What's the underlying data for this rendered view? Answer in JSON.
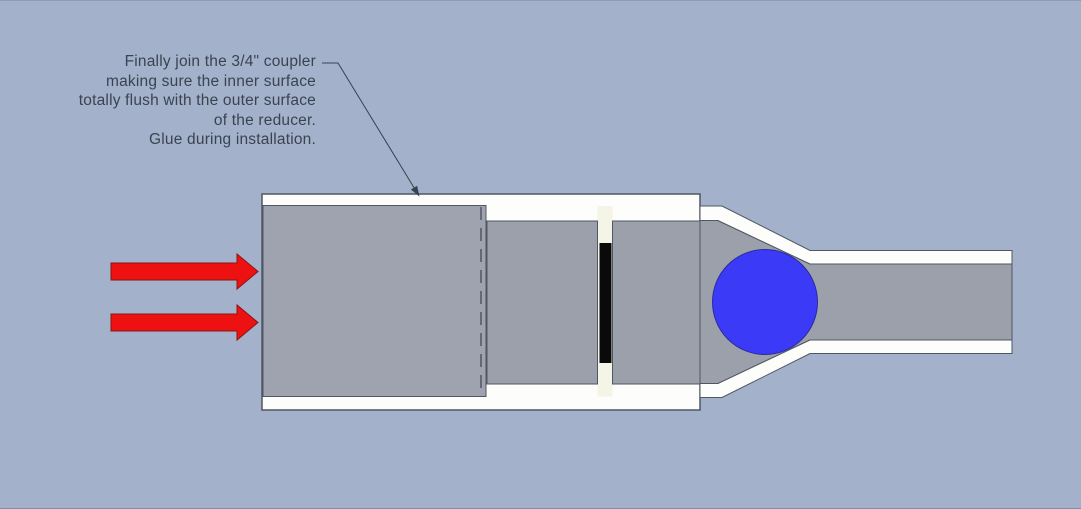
{
  "annotation": {
    "lines": [
      "Finally join the 3/4\" coupler",
      "making sure the inner surface",
      "totally flush with the outer surface",
      "of the reducer.",
      "Glue during installation."
    ]
  },
  "colors": {
    "background": "#A3B1CB",
    "edge_top": "#8C9EB8",
    "edge_bottom": "#7E90A8",
    "white": "#FDFDFB",
    "cream": "#F5F5E7",
    "pipe_gray_left": "#9EA3AF",
    "pipe_gray": "#9BA0AA",
    "outline": "#4E5763",
    "stop_black": "#0A0A0A",
    "ball_blue": "#3B3BF7",
    "arrow_red": "#EE1111",
    "leader": "#39424F",
    "text": "#3B4350"
  }
}
